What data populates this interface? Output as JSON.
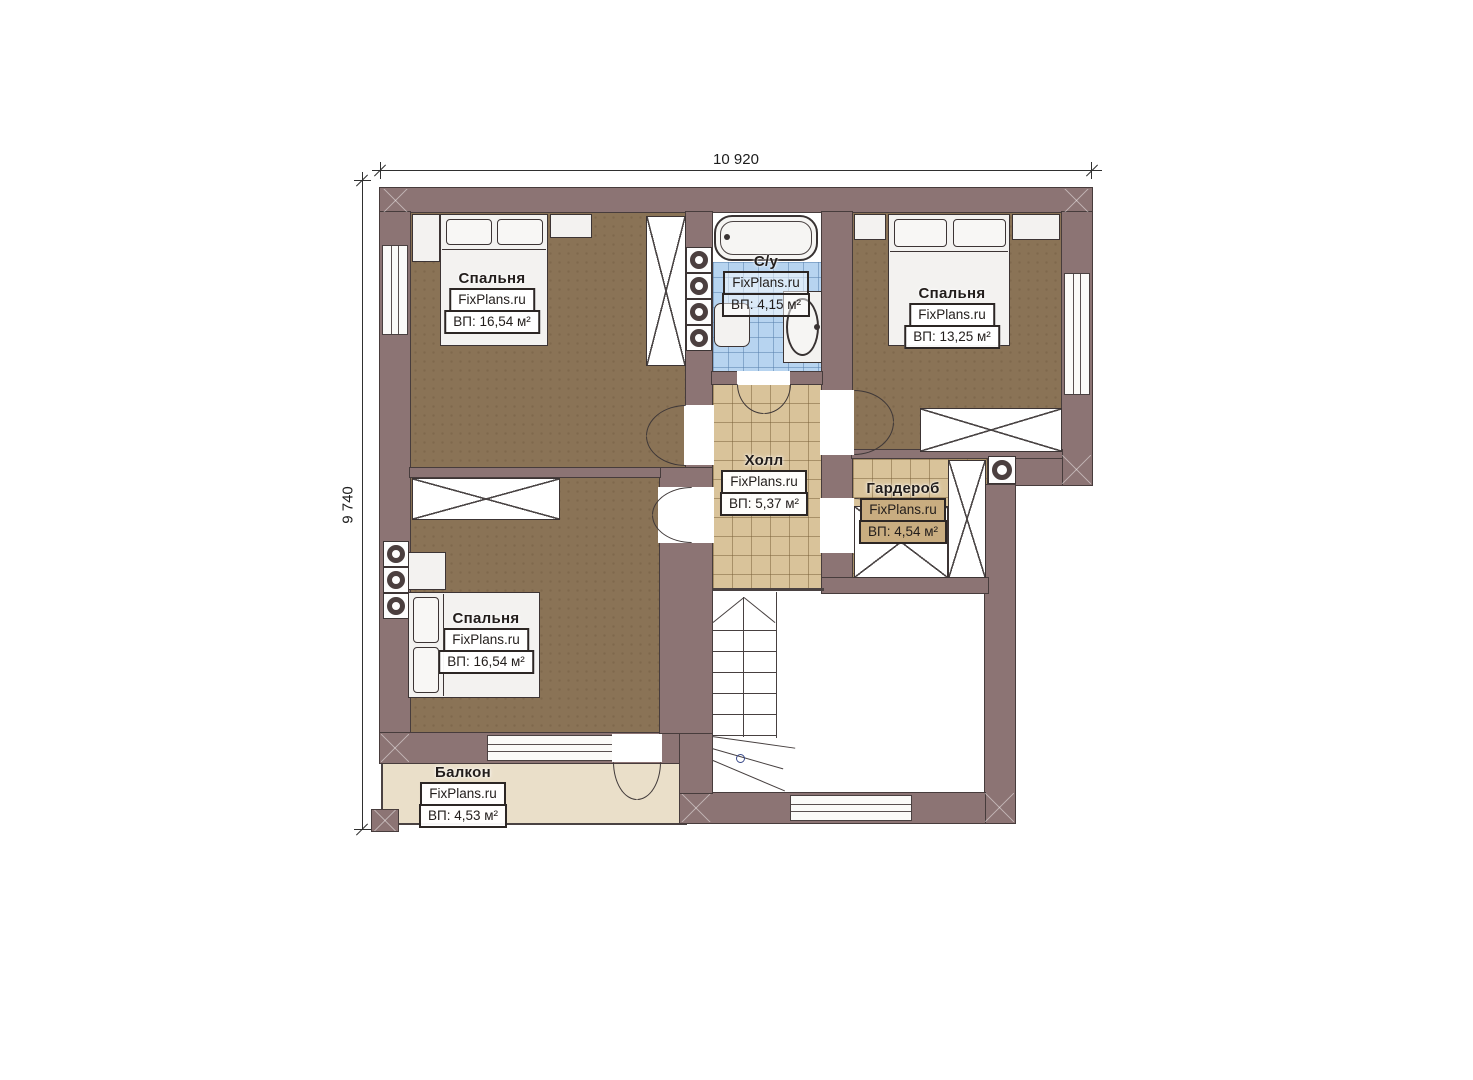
{
  "dimensions": {
    "width_label": "10 920",
    "height_label": "9 740"
  },
  "brand": "FixPlans.ru",
  "rooms": {
    "bedroom_top_left": {
      "name": "Спальня",
      "area": "ВП: 16,54 м²"
    },
    "bathroom": {
      "name": "С/у",
      "area": "ВП: 4,15 м²"
    },
    "bedroom_right": {
      "name": "Спальня",
      "area": "ВП: 13,25 м²"
    },
    "hall": {
      "name": "Холл",
      "area": "ВП: 5,37 м²"
    },
    "wardrobe": {
      "name": "Гардероб",
      "area": "ВП: 4,54 м²"
    },
    "bedroom_bottom_left": {
      "name": "Спальня",
      "area": "ВП: 16,54 м²"
    },
    "balcony": {
      "name": "Балкон",
      "area": "ВП: 4,53 м²"
    }
  },
  "colors": {
    "wall": "#8c7474",
    "bedroom_floor": "#8a7356",
    "bath_tile": "#b7d4f0",
    "hall_tile": "#d9c39a",
    "balcony_floor": "#eadfc9"
  }
}
